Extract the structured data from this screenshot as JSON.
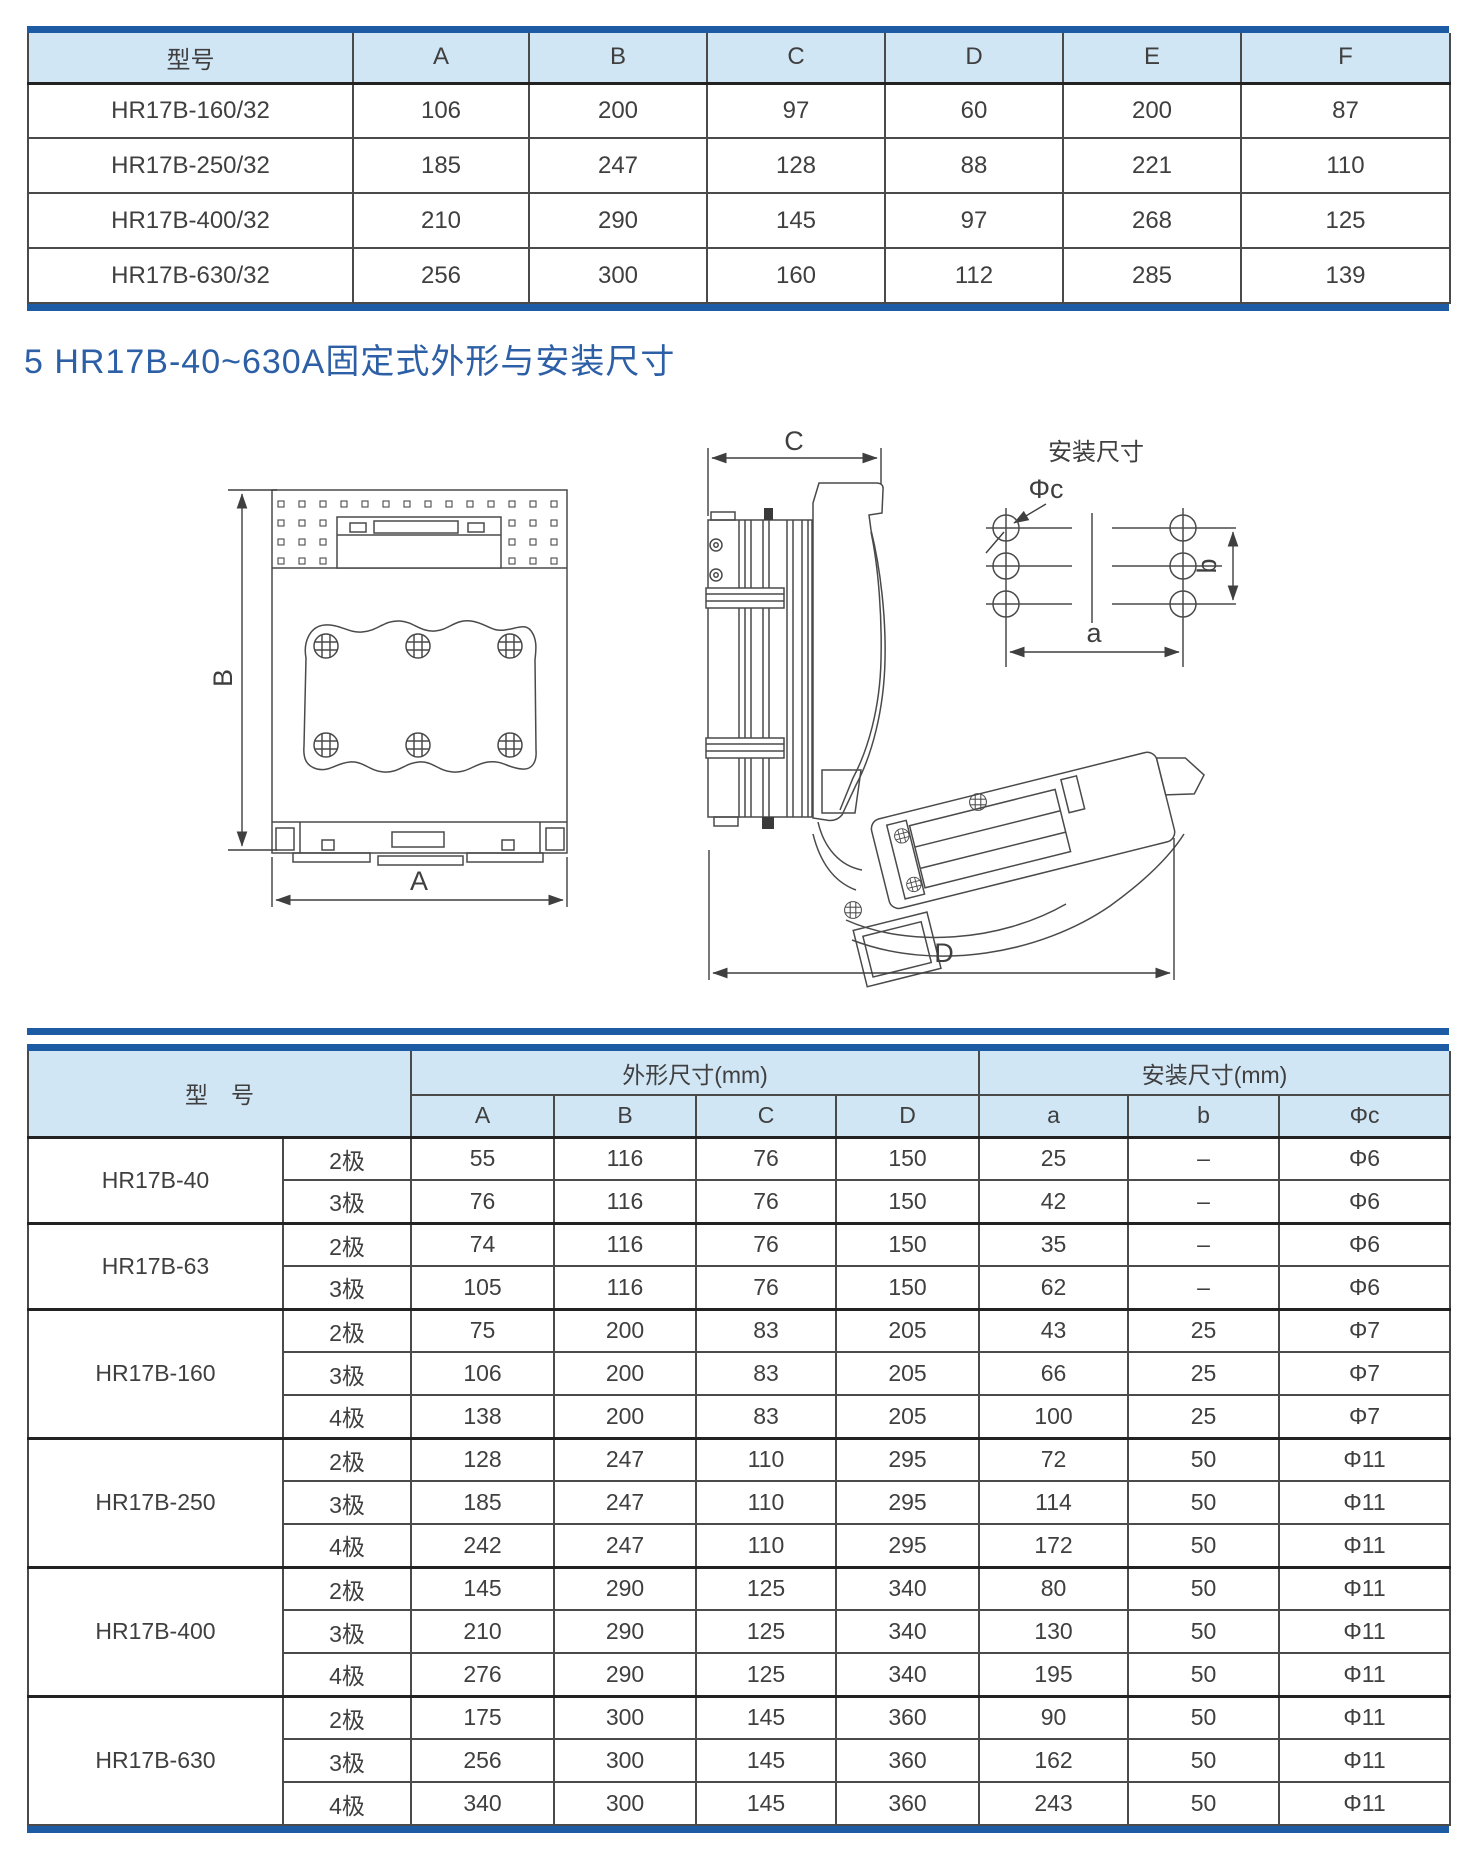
{
  "colors": {
    "accent_blue": "#1d5ca5",
    "table_header_bg": "#d0e6f5",
    "heading_text": "#2c5fa6",
    "line_color": "#4a4a4a"
  },
  "section_heading": "5 HR17B-40~630A固定式外形与安装尺寸",
  "top_table": {
    "columns": [
      "型号",
      "A",
      "B",
      "C",
      "D",
      "E",
      "F"
    ],
    "rows": [
      {
        "model": "HR17B-160/32",
        "values": [
          "106",
          "200",
          "97",
          "60",
          "200",
          "87"
        ]
      },
      {
        "model": "HR17B-250/32",
        "values": [
          "185",
          "247",
          "128",
          "88",
          "221",
          "110"
        ]
      },
      {
        "model": "HR17B-400/32",
        "values": [
          "210",
          "290",
          "145",
          "97",
          "268",
          "125"
        ]
      },
      {
        "model": "HR17B-630/32",
        "values": [
          "256",
          "300",
          "160",
          "112",
          "285",
          "139"
        ]
      }
    ]
  },
  "drawings": {
    "front_view": {
      "width_label": "A",
      "height_label": "B"
    },
    "side_view": {
      "depth_label": "C",
      "total_depth_label": "D"
    },
    "mounting": {
      "title": "安装尺寸",
      "hole_diameter_label": "Φc",
      "pitch_horizontal_label": "a",
      "pitch_vertical_label": "b"
    }
  },
  "bottom_table": {
    "model_header": "型　号",
    "group_headers": [
      {
        "label": "外形尺寸(mm)",
        "columns": [
          "A",
          "B",
          "C",
          "D"
        ]
      },
      {
        "label": "安装尺寸(mm)",
        "columns": [
          "a",
          "b",
          "Φc"
        ]
      }
    ],
    "groups": [
      {
        "model": "HR17B-40",
        "rows": [
          {
            "pole": "2极",
            "values": [
              "55",
              "116",
              "76",
              "150",
              "25",
              "–",
              "Φ6"
            ]
          },
          {
            "pole": "3极",
            "values": [
              "76",
              "116",
              "76",
              "150",
              "42",
              "–",
              "Φ6"
            ]
          }
        ]
      },
      {
        "model": "HR17B-63",
        "rows": [
          {
            "pole": "2极",
            "values": [
              "74",
              "116",
              "76",
              "150",
              "35",
              "–",
              "Φ6"
            ]
          },
          {
            "pole": "3极",
            "values": [
              "105",
              "116",
              "76",
              "150",
              "62",
              "–",
              "Φ6"
            ]
          }
        ]
      },
      {
        "model": "HR17B-160",
        "rows": [
          {
            "pole": "2极",
            "values": [
              "75",
              "200",
              "83",
              "205",
              "43",
              "25",
              "Φ7"
            ]
          },
          {
            "pole": "3极",
            "values": [
              "106",
              "200",
              "83",
              "205",
              "66",
              "25",
              "Φ7"
            ]
          },
          {
            "pole": "4极",
            "values": [
              "138",
              "200",
              "83",
              "205",
              "100",
              "25",
              "Φ7"
            ]
          }
        ]
      },
      {
        "model": "HR17B-250",
        "rows": [
          {
            "pole": "2极",
            "values": [
              "128",
              "247",
              "110",
              "295",
              "72",
              "50",
              "Φ11"
            ]
          },
          {
            "pole": "3极",
            "values": [
              "185",
              "247",
              "110",
              "295",
              "114",
              "50",
              "Φ11"
            ]
          },
          {
            "pole": "4极",
            "values": [
              "242",
              "247",
              "110",
              "295",
              "172",
              "50",
              "Φ11"
            ]
          }
        ]
      },
      {
        "model": "HR17B-400",
        "rows": [
          {
            "pole": "2极",
            "values": [
              "145",
              "290",
              "125",
              "340",
              "80",
              "50",
              "Φ11"
            ]
          },
          {
            "pole": "3极",
            "values": [
              "210",
              "290",
              "125",
              "340",
              "130",
              "50",
              "Φ11"
            ]
          },
          {
            "pole": "4极",
            "values": [
              "276",
              "290",
              "125",
              "340",
              "195",
              "50",
              "Φ11"
            ]
          }
        ]
      },
      {
        "model": "HR17B-630",
        "rows": [
          {
            "pole": "2极",
            "values": [
              "175",
              "300",
              "145",
              "360",
              "90",
              "50",
              "Φ11"
            ]
          },
          {
            "pole": "3极",
            "values": [
              "256",
              "300",
              "145",
              "360",
              "162",
              "50",
              "Φ11"
            ]
          },
          {
            "pole": "4极",
            "values": [
              "340",
              "300",
              "145",
              "360",
              "243",
              "50",
              "Φ11"
            ]
          }
        ]
      }
    ]
  }
}
